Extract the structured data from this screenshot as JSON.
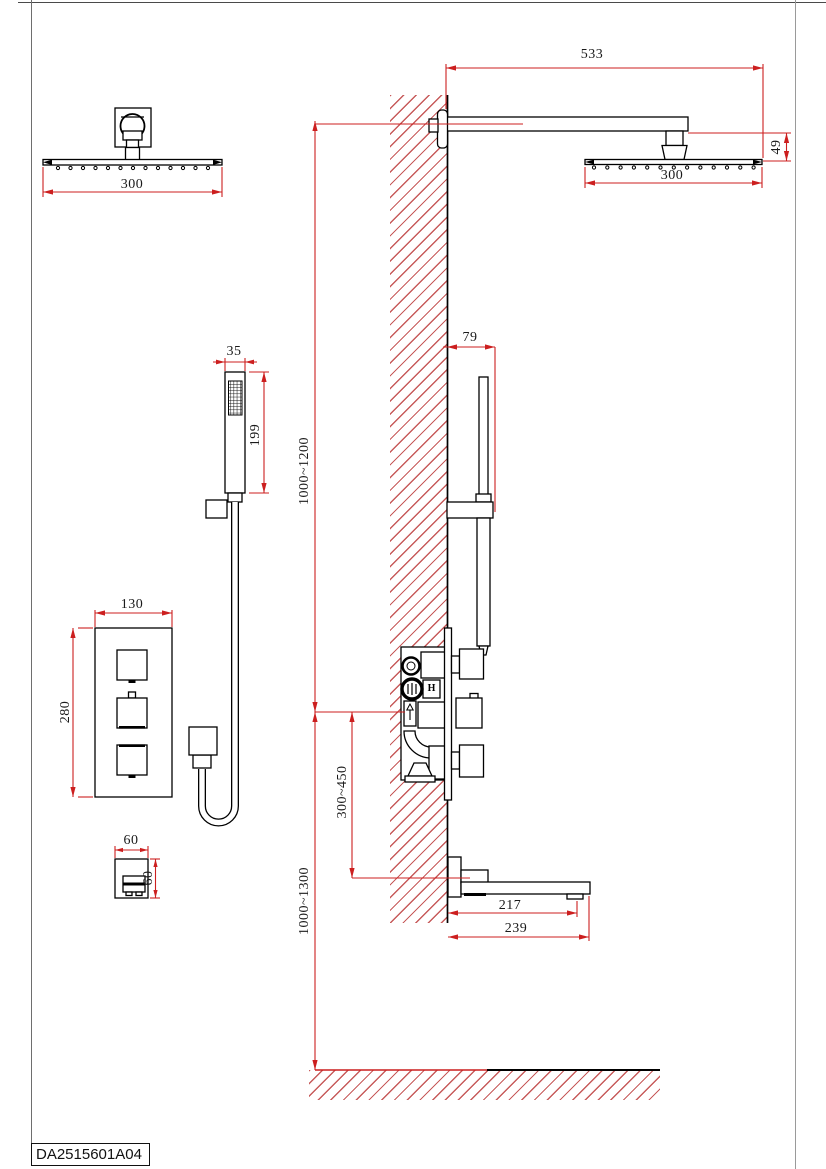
{
  "title_block": {
    "drawing_code": "DA2515601A04"
  },
  "colors": {
    "dimension_red": "#cc1f1f",
    "hatch_red": "#c75b5b",
    "line_black": "#000000"
  },
  "dims": {
    "overhead_front_width": "300",
    "arm_projection": "533",
    "overhead_side_width": "300",
    "head_drop": "49",
    "handshower_width": "35",
    "handshower_length": "199",
    "bar_wall_offset": "79",
    "mixer_width": "130",
    "mixer_height": "280",
    "outlet_width": "60",
    "outlet_height": "60",
    "spout_outlet_reach": "217",
    "spout_total_reach": "239",
    "handshower_mount_height": "1000~1200",
    "mixer_to_spout_drop": "300~450",
    "mixer_mount_height": "1000~1300"
  },
  "valve": {
    "hot_marker": "H"
  }
}
